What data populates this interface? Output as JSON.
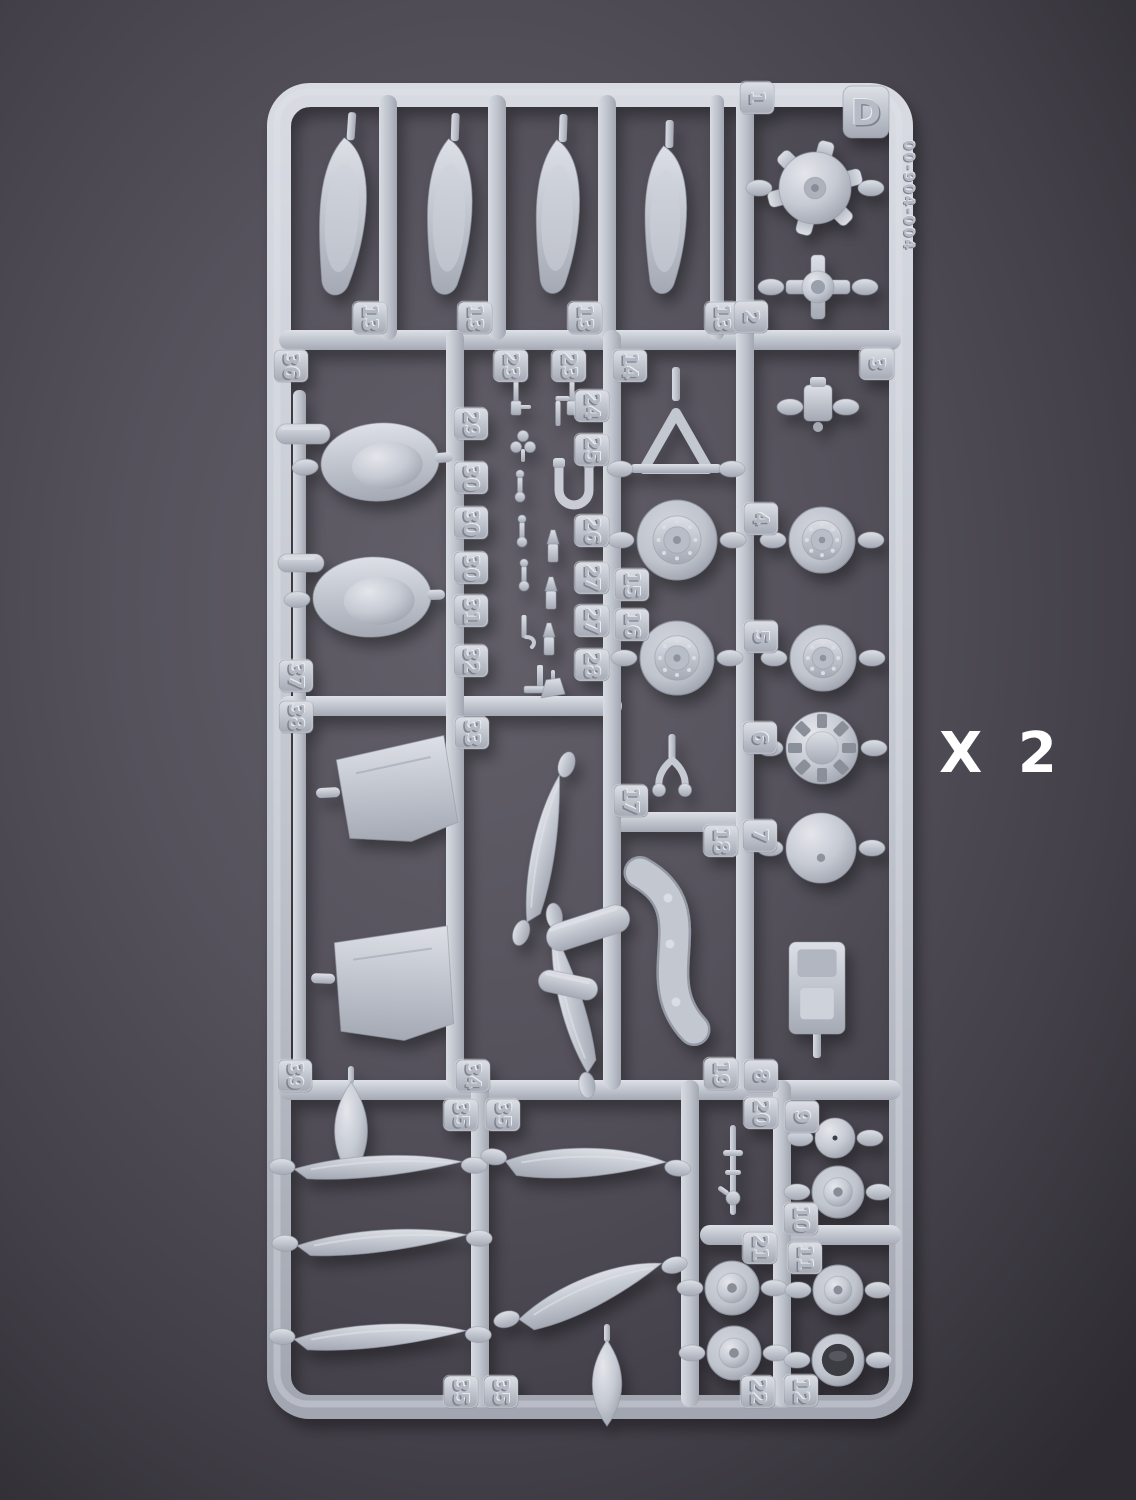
{
  "photo": {
    "sprue_letter": "D",
    "mold_code": "00-904-004",
    "multiplier_label": "X 2"
  },
  "colors": {
    "background_center": "#63606a",
    "background_edge": "#2e2c32",
    "plastic_light": "#dde0e6",
    "plastic_base": "#c3c7d0",
    "plastic_shadow": "#a5a9b4",
    "multiplier_text": "#ffffff"
  },
  "part_number_tags": [
    {
      "label": "1",
      "x": 757,
      "y": 98
    },
    {
      "label": "13",
      "x": 370,
      "y": 318
    },
    {
      "label": "13",
      "x": 475,
      "y": 318
    },
    {
      "label": "13",
      "x": 585,
      "y": 318
    },
    {
      "label": "13",
      "x": 722,
      "y": 318
    },
    {
      "label": "2",
      "x": 751,
      "y": 317
    },
    {
      "label": "3",
      "x": 877,
      "y": 364
    },
    {
      "label": "36",
      "x": 291,
      "y": 366
    },
    {
      "label": "23",
      "x": 511,
      "y": 366
    },
    {
      "label": "23",
      "x": 569,
      "y": 366
    },
    {
      "label": "14",
      "x": 630,
      "y": 366
    },
    {
      "label": "29",
      "x": 471,
      "y": 424
    },
    {
      "label": "24",
      "x": 592,
      "y": 406
    },
    {
      "label": "25",
      "x": 592,
      "y": 450
    },
    {
      "label": "30",
      "x": 471,
      "y": 478
    },
    {
      "label": "30",
      "x": 471,
      "y": 523
    },
    {
      "label": "30",
      "x": 471,
      "y": 568
    },
    {
      "label": "31",
      "x": 471,
      "y": 611
    },
    {
      "label": "32",
      "x": 471,
      "y": 661
    },
    {
      "label": "26",
      "x": 592,
      "y": 531
    },
    {
      "label": "27",
      "x": 592,
      "y": 578
    },
    {
      "label": "27",
      "x": 592,
      "y": 621
    },
    {
      "label": "28",
      "x": 592,
      "y": 665
    },
    {
      "label": "15",
      "x": 632,
      "y": 585
    },
    {
      "label": "16",
      "x": 632,
      "y": 625
    },
    {
      "label": "4",
      "x": 761,
      "y": 519
    },
    {
      "label": "5",
      "x": 761,
      "y": 637
    },
    {
      "label": "6",
      "x": 760,
      "y": 738
    },
    {
      "label": "7",
      "x": 760,
      "y": 836
    },
    {
      "label": "37",
      "x": 296,
      "y": 676
    },
    {
      "label": "38",
      "x": 296,
      "y": 717
    },
    {
      "label": "33",
      "x": 472,
      "y": 733
    },
    {
      "label": "17",
      "x": 631,
      "y": 801
    },
    {
      "label": "18",
      "x": 721,
      "y": 841
    },
    {
      "label": "39",
      "x": 295,
      "y": 1076
    },
    {
      "label": "34",
      "x": 473,
      "y": 1076
    },
    {
      "label": "35",
      "x": 461,
      "y": 1115
    },
    {
      "label": "35",
      "x": 503,
      "y": 1115
    },
    {
      "label": "19",
      "x": 721,
      "y": 1074
    },
    {
      "label": "8",
      "x": 761,
      "y": 1076
    },
    {
      "label": "20",
      "x": 761,
      "y": 1113
    },
    {
      "label": "9",
      "x": 802,
      "y": 1117
    },
    {
      "label": "10",
      "x": 801,
      "y": 1219
    },
    {
      "label": "21",
      "x": 760,
      "y": 1248
    },
    {
      "label": "11",
      "x": 805,
      "y": 1258
    },
    {
      "label": "22",
      "x": 758,
      "y": 1392
    },
    {
      "label": "12",
      "x": 801,
      "y": 1391
    },
    {
      "label": "35",
      "x": 461,
      "y": 1392
    },
    {
      "label": "35",
      "x": 501,
      "y": 1392
    }
  ],
  "parts": [
    {
      "name": "gear-door-panel",
      "shape": "door",
      "x": 345,
      "y": 218,
      "w": 64,
      "h": 160,
      "rot": 4
    },
    {
      "name": "gear-door-panel",
      "shape": "door",
      "x": 452,
      "y": 218,
      "w": 62,
      "h": 158,
      "rot": 2
    },
    {
      "name": "gear-door-panel",
      "shape": "door",
      "x": 560,
      "y": 218,
      "w": 60,
      "h": 156,
      "rot": 2
    },
    {
      "name": "gear-door-panel",
      "shape": "door",
      "x": 668,
      "y": 221,
      "w": 58,
      "h": 150,
      "rot": 1
    },
    {
      "name": "engine-crankcase",
      "shape": "crankcase",
      "x": 815,
      "y": 188,
      "r": 36
    },
    {
      "name": "control-cross-fitting",
      "shape": "cross",
      "x": 818,
      "y": 287,
      "w": 64
    },
    {
      "name": "cowl-fairing",
      "shape": "fairing",
      "x": 380,
      "y": 462,
      "w": 118,
      "h": 78,
      "rot": -4
    },
    {
      "name": "cowl-fairing",
      "shape": "fairing",
      "x": 372,
      "y": 597,
      "w": 118,
      "h": 80,
      "rot": -2
    },
    {
      "name": "small-capsule-part",
      "shape": "capsule",
      "x": 303,
      "y": 434,
      "w": 54,
      "h": 20,
      "rot": 0
    },
    {
      "name": "small-capsule-part",
      "shape": "capsule",
      "x": 301,
      "y": 563,
      "w": 46,
      "h": 18,
      "rot": 0
    },
    {
      "name": "machine-gun-part",
      "shape": "gunS",
      "x": 516,
      "y": 399
    },
    {
      "name": "machine-gun-part",
      "shape": "gunS",
      "x": 572,
      "y": 399
    },
    {
      "name": "clover-fitting",
      "shape": "clover",
      "x": 523,
      "y": 443
    },
    {
      "name": "pin-fitting",
      "shape": "pinS",
      "x": 520,
      "y": 489
    },
    {
      "name": "pin-fitting",
      "shape": "pinS",
      "x": 522,
      "y": 534
    },
    {
      "name": "pin-fitting",
      "shape": "pinS",
      "x": 524,
      "y": 578
    },
    {
      "name": "hook-pin-fitting",
      "shape": "hook",
      "x": 524,
      "y": 629
    },
    {
      "name": "pedal-stand-fitting",
      "shape": "stand",
      "x": 540,
      "y": 681
    },
    {
      "name": "lever-pin-fitting",
      "shape": "lpin",
      "x": 558,
      "y": 413
    },
    {
      "name": "u-pipe-fitting",
      "shape": "upipe",
      "x": 574,
      "y": 484
    },
    {
      "name": "nozzle-fitting",
      "shape": "nozzle",
      "x": 553,
      "y": 548
    },
    {
      "name": "nozzle-fitting",
      "shape": "nozzle",
      "x": 551,
      "y": 595
    },
    {
      "name": "nozzle-fitting",
      "shape": "nozzle",
      "x": 549,
      "y": 641
    },
    {
      "name": "wedge-fitting",
      "shape": "wedge",
      "x": 553,
      "y": 688
    },
    {
      "name": "tailwheel-strut",
      "shape": "tristrut",
      "x": 676,
      "y": 445
    },
    {
      "name": "main-wheel",
      "shape": "wheel",
      "x": 677,
      "y": 540,
      "r": 40
    },
    {
      "name": "main-wheel",
      "shape": "wheel",
      "x": 677,
      "y": 658,
      "r": 37
    },
    {
      "name": "bracket-fitting",
      "shape": "bracket",
      "x": 818,
      "y": 407
    },
    {
      "name": "main-wheel",
      "shape": "wheel",
      "x": 822,
      "y": 540,
      "r": 33
    },
    {
      "name": "main-wheel",
      "shape": "wheel",
      "x": 823,
      "y": 658,
      "r": 33
    },
    {
      "name": "cowl-flap-ring",
      "shape": "ring",
      "x": 822,
      "y": 748,
      "r": 36
    },
    {
      "name": "spinner-dome",
      "shape": "dome",
      "x": 821,
      "y": 848,
      "r": 35
    },
    {
      "name": "pilot-seat",
      "shape": "seat",
      "x": 817,
      "y": 988,
      "w": 56,
      "h": 92
    },
    {
      "name": "fork-strut",
      "shape": "fork",
      "x": 672,
      "y": 770
    },
    {
      "name": "exhaust-pipe",
      "shape": "pipe",
      "x": 668,
      "y": 950,
      "w": 95,
      "h": 175
    },
    {
      "name": "propeller-blade",
      "shape": "blade",
      "x": 548,
      "y": 850,
      "w": 150,
      "h": 44,
      "rot": -72
    },
    {
      "name": "propeller-blade",
      "shape": "blade",
      "x": 575,
      "y": 1000,
      "w": 148,
      "h": 44,
      "rot": -98
    },
    {
      "name": "hub-capsule",
      "shape": "capsule",
      "x": 588,
      "y": 928,
      "w": 86,
      "h": 28,
      "rot": -18
    },
    {
      "name": "hub-capsule",
      "shape": "capsule",
      "x": 568,
      "y": 985,
      "w": 60,
      "h": 22,
      "rot": 12
    },
    {
      "name": "fuselage-panel",
      "shape": "panel",
      "x": 397,
      "y": 790,
      "w": 118,
      "h": 104,
      "rot": -3
    },
    {
      "name": "fuselage-panel",
      "shape": "panel",
      "x": 394,
      "y": 982,
      "w": 122,
      "h": 116,
      "rot": 2
    },
    {
      "name": "fuel-tank-bomb",
      "shape": "bomb",
      "x": 351,
      "y": 1130,
      "w": 38,
      "h": 96
    },
    {
      "name": "propeller-blade",
      "shape": "blade",
      "x": 378,
      "y": 1170,
      "w": 168,
      "h": 40,
      "rot": 2
    },
    {
      "name": "propeller-blade",
      "shape": "blade",
      "x": 382,
      "y": 1245,
      "w": 170,
      "h": 42,
      "rot": 1
    },
    {
      "name": "propeller-blade",
      "shape": "blade",
      "x": 380,
      "y": 1340,
      "w": 172,
      "h": 44,
      "rot": 2
    },
    {
      "name": "propeller-blade",
      "shape": "blade",
      "x": 585,
      "y": 1168,
      "w": 160,
      "h": 56,
      "rot": 7
    },
    {
      "name": "propeller-blade",
      "shape": "blade",
      "x": 592,
      "y": 1298,
      "w": 152,
      "h": 60,
      "rot": -14
    },
    {
      "name": "fuel-tank-bomb",
      "shape": "bomb",
      "x": 607,
      "y": 1383,
      "w": 34,
      "h": 86
    },
    {
      "name": "machine-gun-part",
      "shape": "gun",
      "x": 733,
      "y": 1170
    },
    {
      "name": "antenna-disc",
      "shape": "disc",
      "x": 835,
      "y": 1138,
      "r": 20
    },
    {
      "name": "tail-wheel",
      "shape": "hub",
      "x": 838,
      "y": 1192,
      "r": 26
    },
    {
      "name": "wheel-hub",
      "shape": "hub",
      "x": 732,
      "y": 1288,
      "r": 27
    },
    {
      "name": "wheel-hub",
      "shape": "hub",
      "x": 838,
      "y": 1290,
      "r": 25
    },
    {
      "name": "wheel-hub",
      "shape": "hub",
      "x": 734,
      "y": 1353,
      "r": 27
    },
    {
      "name": "intake-cup",
      "shape": "cup",
      "x": 838,
      "y": 1360,
      "r": 26
    }
  ]
}
